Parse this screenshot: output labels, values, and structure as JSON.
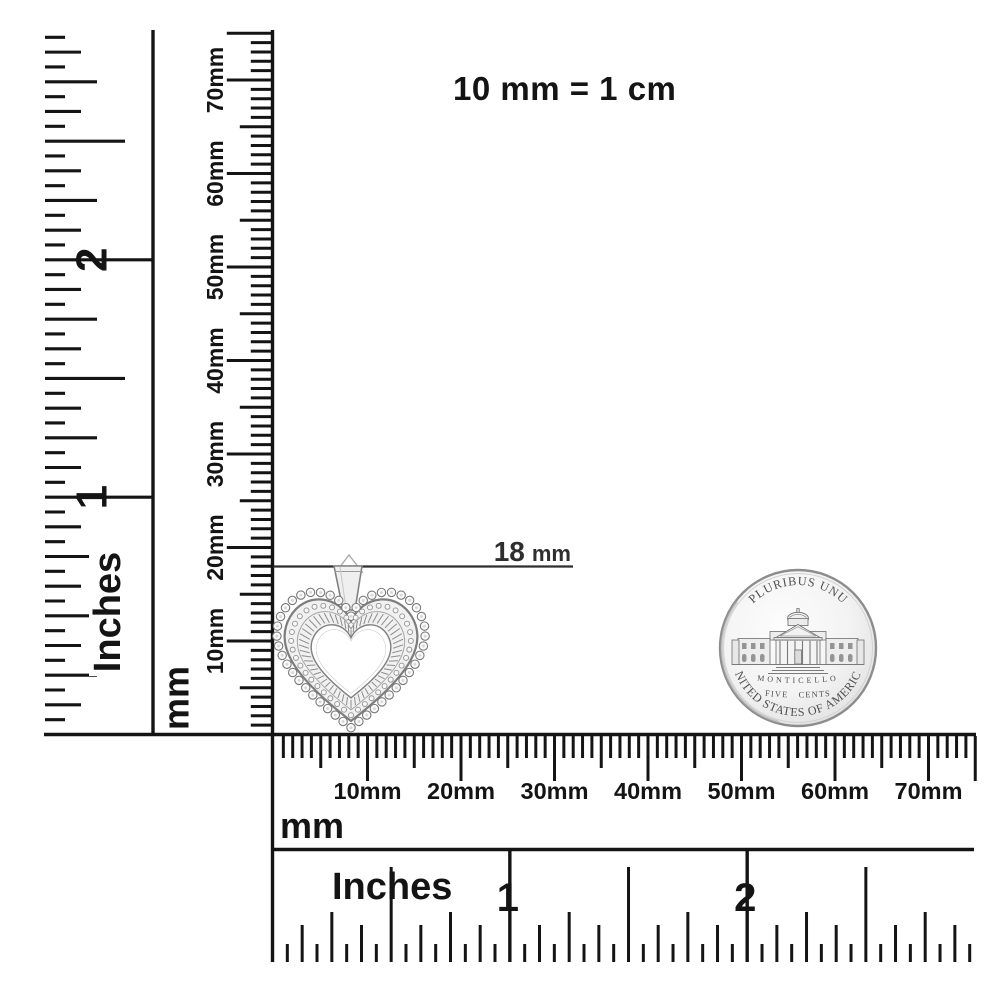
{
  "note": {
    "text": "10 mm = 1 cm"
  },
  "annotation": {
    "value": "18",
    "unit": "mm"
  },
  "rulers": {
    "left_inches": {
      "unit": "Inches",
      "inch_labels": [
        "1",
        "2"
      ]
    },
    "left_mm": {
      "unit": "mm",
      "labels": [
        "10mm",
        "20mm",
        "30mm",
        "40mm",
        "50mm",
        "60mm",
        "70mm"
      ]
    },
    "bottom_mm": {
      "unit": "mm",
      "labels": [
        "10mm",
        "20mm",
        "30mm",
        "40mm",
        "50mm",
        "60mm",
        "70mm"
      ]
    },
    "bottom_inches": {
      "unit": "Inches",
      "inch_labels": [
        "1",
        "2"
      ]
    }
  },
  "coin": {
    "top_text": "E PLURIBUS UNUM",
    "building_label": "MONTICELLO",
    "denomination": "FIVE CENTS",
    "bottom_text": "UNITED STATES OF AMERICA"
  },
  "colors": {
    "ink": "#141414",
    "annotation_ink": "#2e2e2e",
    "metal_edge": "#7d7d7d",
    "coin_rim": "#8d8d8d",
    "coin_text": "#4f4f4f"
  }
}
